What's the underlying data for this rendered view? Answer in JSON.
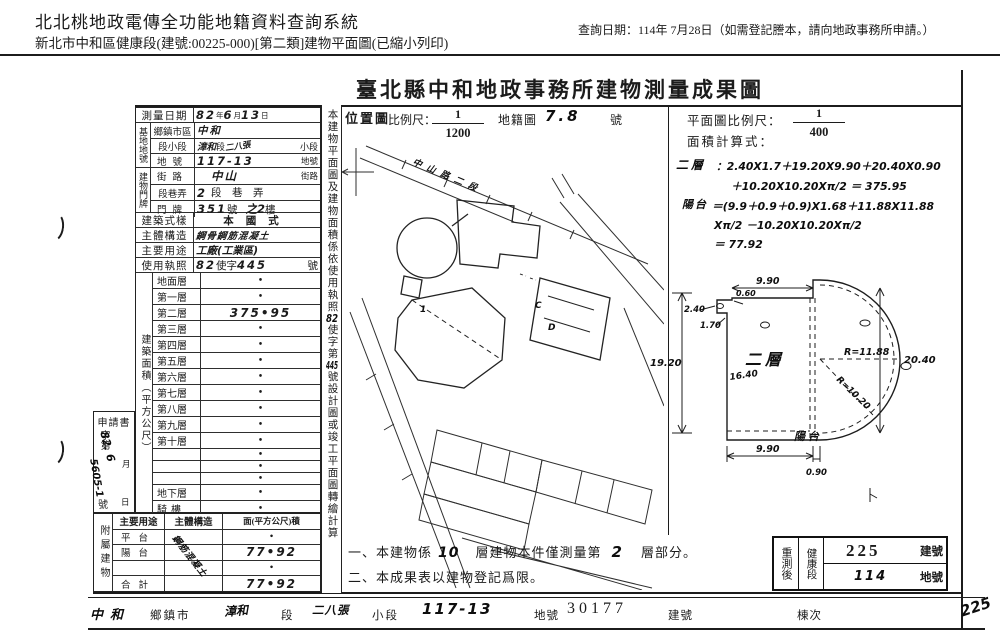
{
  "header": {
    "system_title": "北北桃地政電傳全功能地籍資料查詢系統",
    "subtitle": "新北市中和區健康段(建號:00225-000)[第二類]建物平面圖(已縮小列印)",
    "query_date": "查詢日期：114年 7月28日（如需登記謄本，請向地政事務所申請。）"
  },
  "doc_title": "臺北縣中和地政事務所建物測量成果圖",
  "survey": {
    "date": {
      "label": "測量日期",
      "y": "82",
      "y_u": "年",
      "m": "6",
      "m_u": "月",
      "d": "13",
      "d_u": "日"
    },
    "site_group": "基地地號",
    "site_rows": [
      {
        "label": "鄉鎮市區",
        "hw": "中和",
        "mid": "",
        "hw2": "",
        "suffix": ""
      },
      {
        "label": "段小段",
        "hw": "漳和",
        "mid": "段",
        "hw2": "二八張",
        "suffix": "小段"
      },
      {
        "label": "地號",
        "hw": "117-13",
        "mid": "",
        "hw2": "",
        "suffix": "地號"
      }
    ],
    "door_group": "建物門牌",
    "door_rows": [
      {
        "label": "街路",
        "hw": "中山",
        "mid": "",
        "hw2": "",
        "suffix": "街路"
      },
      {
        "label": "段巷弄",
        "hw": "2",
        "mid": "",
        "hw2": "",
        "suffix": "段　巷　弄"
      },
      {
        "label": "門牌",
        "hw": "351",
        "mid": "號",
        "hw2": "之2",
        "suffix": "樓"
      }
    ],
    "style": {
      "label": "建築式樣",
      "value": "本國式"
    },
    "structure": {
      "label": "主體構造",
      "hw": "鋼骨鋼筋混凝土"
    },
    "usage": {
      "label": "主要用途",
      "hw": "工廠(工業區)"
    },
    "license": {
      "label": "使用執照",
      "hw1": "82",
      "mid": "使字",
      "hw2": "445",
      "suffix": "號"
    }
  },
  "area": {
    "group": "建築面積（平方公尺）",
    "floors": [
      {
        "label": "地面層",
        "value": "•"
      },
      {
        "label": "第一層",
        "value": "•"
      },
      {
        "label": "第二層",
        "value": "375•95"
      },
      {
        "label": "第三層",
        "value": "•"
      },
      {
        "label": "第四層",
        "value": "•"
      },
      {
        "label": "第五層",
        "value": "•"
      },
      {
        "label": "第六層",
        "value": "•"
      },
      {
        "label": "第七層",
        "value": "•"
      },
      {
        "label": "第八層",
        "value": "•"
      },
      {
        "label": "第九層",
        "value": "•"
      },
      {
        "label": "第十層",
        "value": "•"
      },
      {
        "label": "",
        "value": "•"
      },
      {
        "label": "",
        "value": "•"
      },
      {
        "label": "",
        "value": "•"
      },
      {
        "label": "地下層",
        "value": "•"
      },
      {
        "label": "騎樓",
        "value": "•"
      },
      {
        "label": "合計",
        "value": "375•95"
      }
    ]
  },
  "application": {
    "title": "申請書",
    "prefix": "字第",
    "hw_date": "82. 6",
    "m_u": "月",
    "hw_no": "5605-1",
    "suffix": "號",
    "d_u": "日"
  },
  "annex": {
    "group": "附屬建物",
    "headers": {
      "use": "主要用途",
      "structure": "主體構造",
      "area": "面(平方公尺)積"
    },
    "struct_hw": "鋼筋混凝土",
    "rows": [
      {
        "use": "平台",
        "area": "•"
      },
      {
        "use": "陽台",
        "area": "77•92"
      },
      {
        "use": "",
        "area": "•"
      },
      {
        "use": "合計",
        "area": "77•92"
      }
    ]
  },
  "side_note": {
    "pre": "本建物平面圖及建物面積係依使用執照",
    "hw1": "82",
    "mid": "使字第",
    "hw2": "445",
    "post": "號設計圖或竣工平面圖轉繪計算"
  },
  "location": {
    "label": "位置圖",
    "scale_label": "比例尺：",
    "scale_num": "1",
    "scale_den": "1200",
    "cad_label": "地籍圖",
    "cad_hw": "7.8",
    "cad_suffix": "號",
    "road_label": "中山路二段",
    "cells": {
      "c1": "C",
      "d1": "D",
      "n1": "1"
    }
  },
  "plan": {
    "scale_label": "平面圖比例尺：",
    "scale_num": "1",
    "scale_den": "400",
    "calc_label": "面積計算式：",
    "formula": [
      {
        "head": "二層",
        "body": "：2.40X1.7＋19.20X9.90＋20.40X0.90"
      },
      {
        "head": "",
        "body": "＋10.20X10.20Xπ/2 ＝ 375.95"
      },
      {
        "head": "陽台",
        "body": "＝(9.9＋0.9＋0.9)X1.68＋11.88X11.88"
      },
      {
        "head": "",
        "body": "Xπ/2 －10.20X10.20Xπ/2"
      },
      {
        "head": "",
        "body": "＝ 77.92"
      }
    ],
    "dims": {
      "left": "19.20",
      "right": "20.40",
      "top": "9.90",
      "bottom": "9.90",
      "bottom_small": "0.90",
      "r_outer": "R=11.88",
      "r_inner": "R=10.20",
      "notch_w": "2.40",
      "notch_h": "1.70",
      "notch_s": "0.60",
      "inner": "16.40"
    },
    "labels": {
      "floor": "二層",
      "balcony": "陽台"
    }
  },
  "notes": {
    "n1a": "一、本建物係",
    "n1_hw1": "10",
    "n1b": "層建物本件僅測量第",
    "n1_hw2": "2",
    "n1c": "層部分。",
    "n2": "二、本成果表以建物登記爲限。"
  },
  "restamp": {
    "label": "重測後",
    "section": "健康段",
    "bno": "225",
    "bno_u": "建號",
    "lno": "114",
    "lno_u": "地號"
  },
  "footer": {
    "f1_hw": "中和",
    "f1": "鄉鎮市",
    "f2_hw": "漳和",
    "f2": "段",
    "f3_hw": "二八張",
    "f3": "小段",
    "f4_hw": "117-13",
    "f4": "地號",
    "f5_v": "30177",
    "f5": "建號",
    "f6": "棟次",
    "scrawl": "225"
  }
}
